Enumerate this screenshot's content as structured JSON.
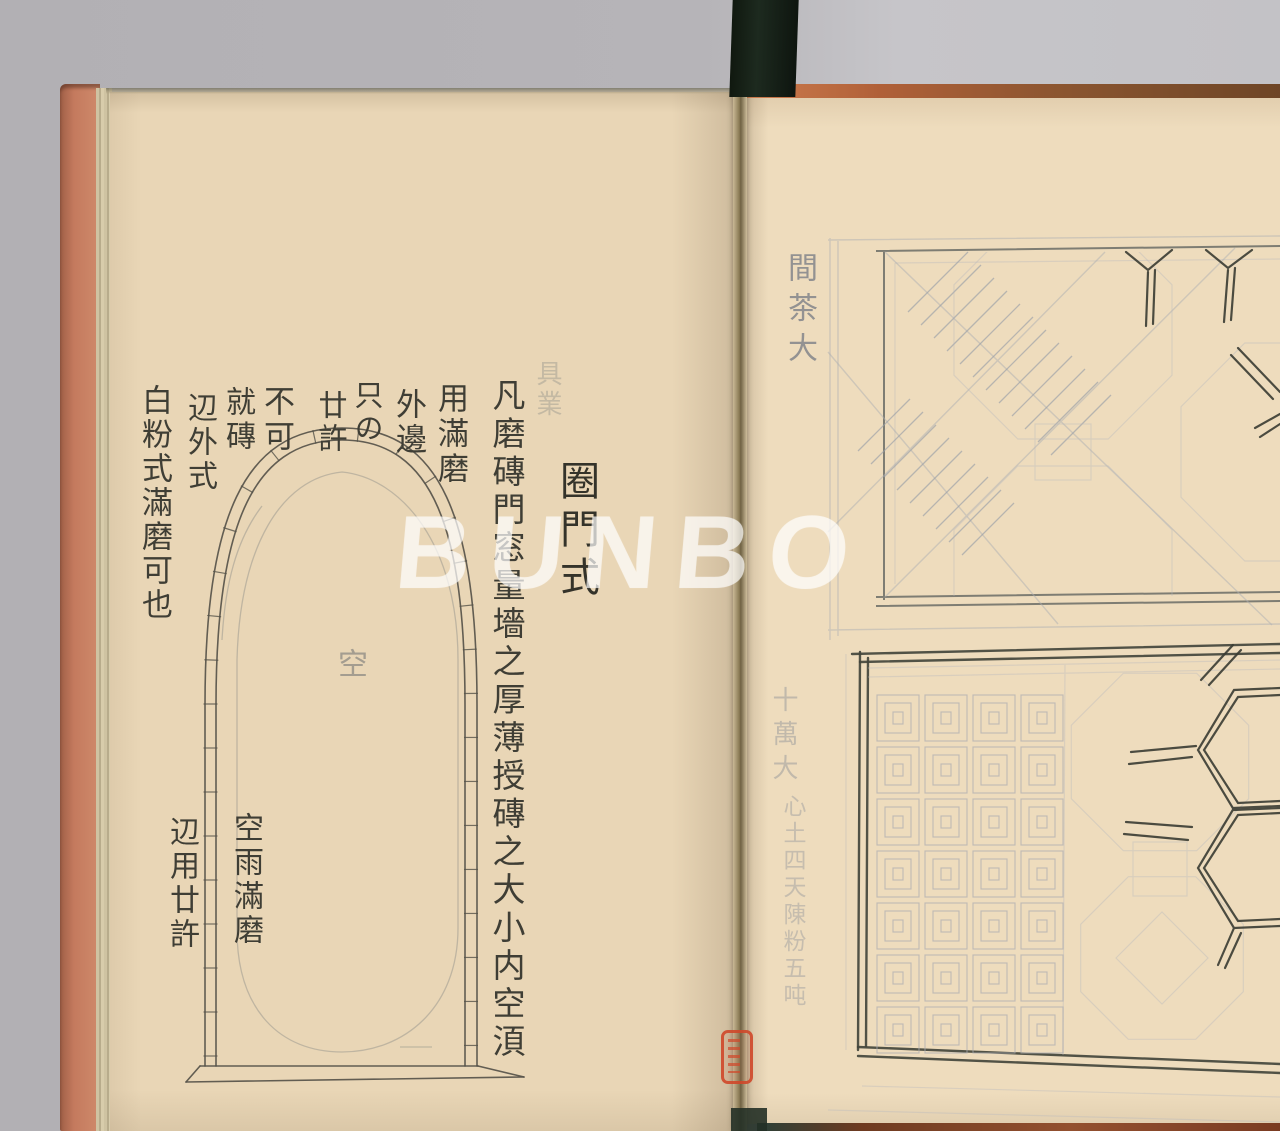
{
  "watermark": "BUNBO",
  "left_page": {
    "title": "圈門式",
    "body_column": "凡磨磚門窓量墻之厚薄授磚之大小内空湏",
    "notes": [
      "用滿磨",
      "外邊",
      "只の",
      "廿許",
      "不可",
      "就磚",
      "辺外式",
      "白粉式滿磨可也"
    ],
    "arch": {
      "inner_label": "空",
      "caption_right": "空雨滿磨",
      "caption_left": "辺用廿許"
    },
    "ghost_text": "具業"
  },
  "right_page": {
    "annotations": {
      "top": "間茶大",
      "middle": "十萬大",
      "lower": "心土四天陳粉五吨"
    }
  },
  "colors": {
    "background": "#b6b4b8",
    "paper_left": "#e9d6b6",
    "paper_right": "#eedcbd",
    "text_ink": "#3f3e35",
    "drawing_ink": "#56534a",
    "pencil": "#a7a9ad",
    "cover_left": "#c47a5e",
    "cover_right": "#a25f35",
    "seal_red": "#d0482a",
    "strap": "#161f19"
  }
}
